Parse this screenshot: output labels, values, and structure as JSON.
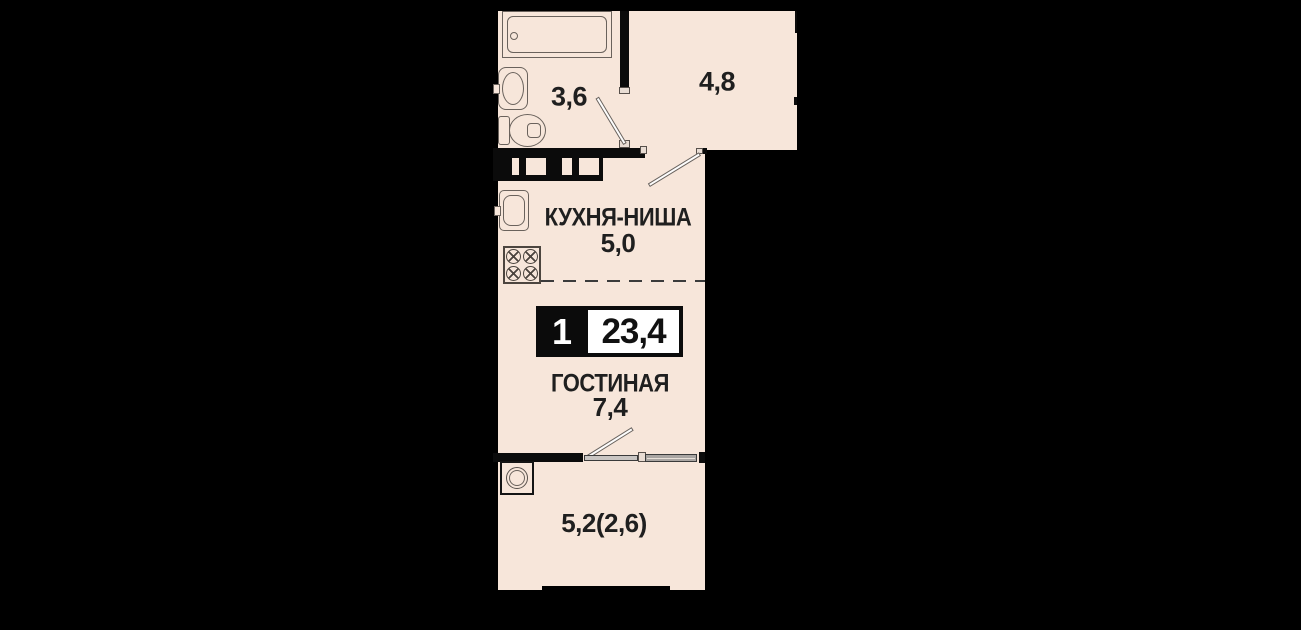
{
  "theme": {
    "bg": "#000000",
    "floor": "#f7e6da",
    "wall": "#0b0b0b",
    "line": "#6a625c",
    "text": "#1f1f1f"
  },
  "badge": {
    "rooms": "1",
    "area": "23,4"
  },
  "rooms": {
    "bathroom": {
      "area": "3,6"
    },
    "hallway": {
      "area": "4,8"
    },
    "kitchen": {
      "name": "КУХНЯ-НИША",
      "area": "5,0"
    },
    "living": {
      "name": "ГОСТИНАЯ",
      "area": "7,4"
    },
    "balcony": {
      "area": "5,2(2,6)"
    }
  },
  "fixtures": [
    "bathtub",
    "bathroom-sink",
    "toilet",
    "ventilation-shaft",
    "kitchen-sink",
    "stove",
    "interior-door",
    "entrance-hall-door",
    "balcony-door",
    "balcony-window",
    "washing-machine",
    "kitchen-niche-dashed-divider"
  ]
}
